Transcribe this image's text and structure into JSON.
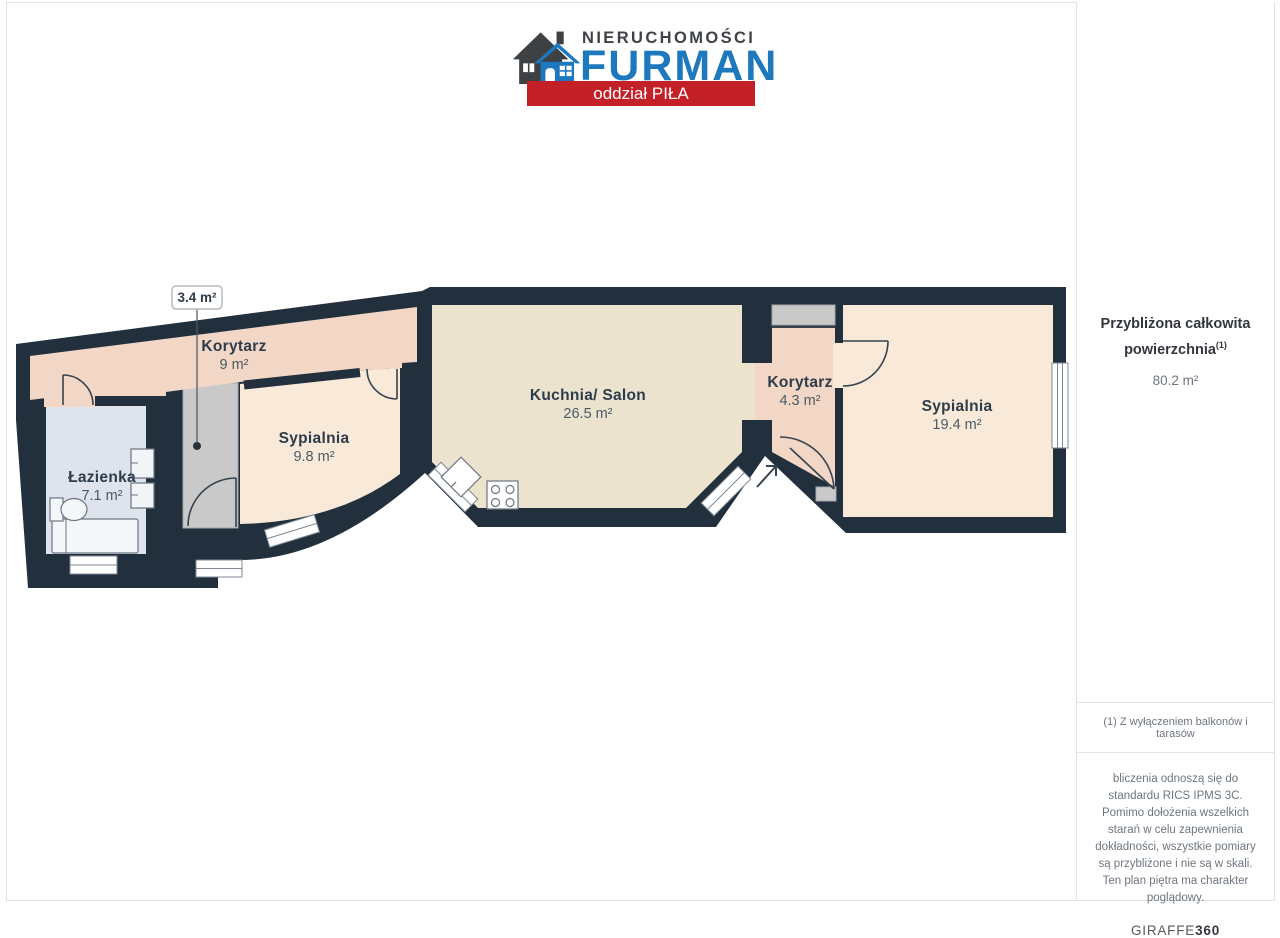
{
  "header": {
    "brand_top": "NIERUCHOMOŚCI",
    "brand_name": "FURMAN",
    "branch": "oddział PIŁA"
  },
  "plan": {
    "rooms": {
      "korytarz9": {
        "name": "Korytarz",
        "area": "9 m²"
      },
      "sypialnia98": {
        "name": "Sypialnia",
        "area": "9.8 m²"
      },
      "lazienka": {
        "name": "Łazienka",
        "area": "7.1 m²"
      },
      "kuchnia": {
        "name": "Kuchnia/ Salon",
        "area": "26.5 m²"
      },
      "korytarz43": {
        "name": "Korytarz",
        "area": "4.3 m²"
      },
      "sypialnia194": {
        "name": "Sypialnia",
        "area": "19.4 m²"
      }
    },
    "callout": {
      "label": "3.4 m²"
    },
    "colors": {
      "wall": "#22303e",
      "corridor": "#f2d7c6",
      "bedroom": "#f9e9d8",
      "kitchen": "#ece3cf",
      "bathroom": "#dfe3ec",
      "closet": "#c9c9c9"
    }
  },
  "sidebar": {
    "total_title": "Przybliżona całkowita powierzchnia",
    "total_sup": "(1)",
    "total_value": "80.2 m²",
    "footnote": "(1) Z wyłączeniem balkonów i tarasów",
    "disclaimer": "bliczenia odnoszą się do standardu RICS IPMS 3C. Pomimo dołożenia wszelkich starań w celu zapewnienia dokładności, wszystkie pomiary są przybliżone i nie są w skali. Ten plan piętra ma charakter poglądowy.",
    "brand": "GIRAFFE",
    "brand_bold": "360"
  }
}
